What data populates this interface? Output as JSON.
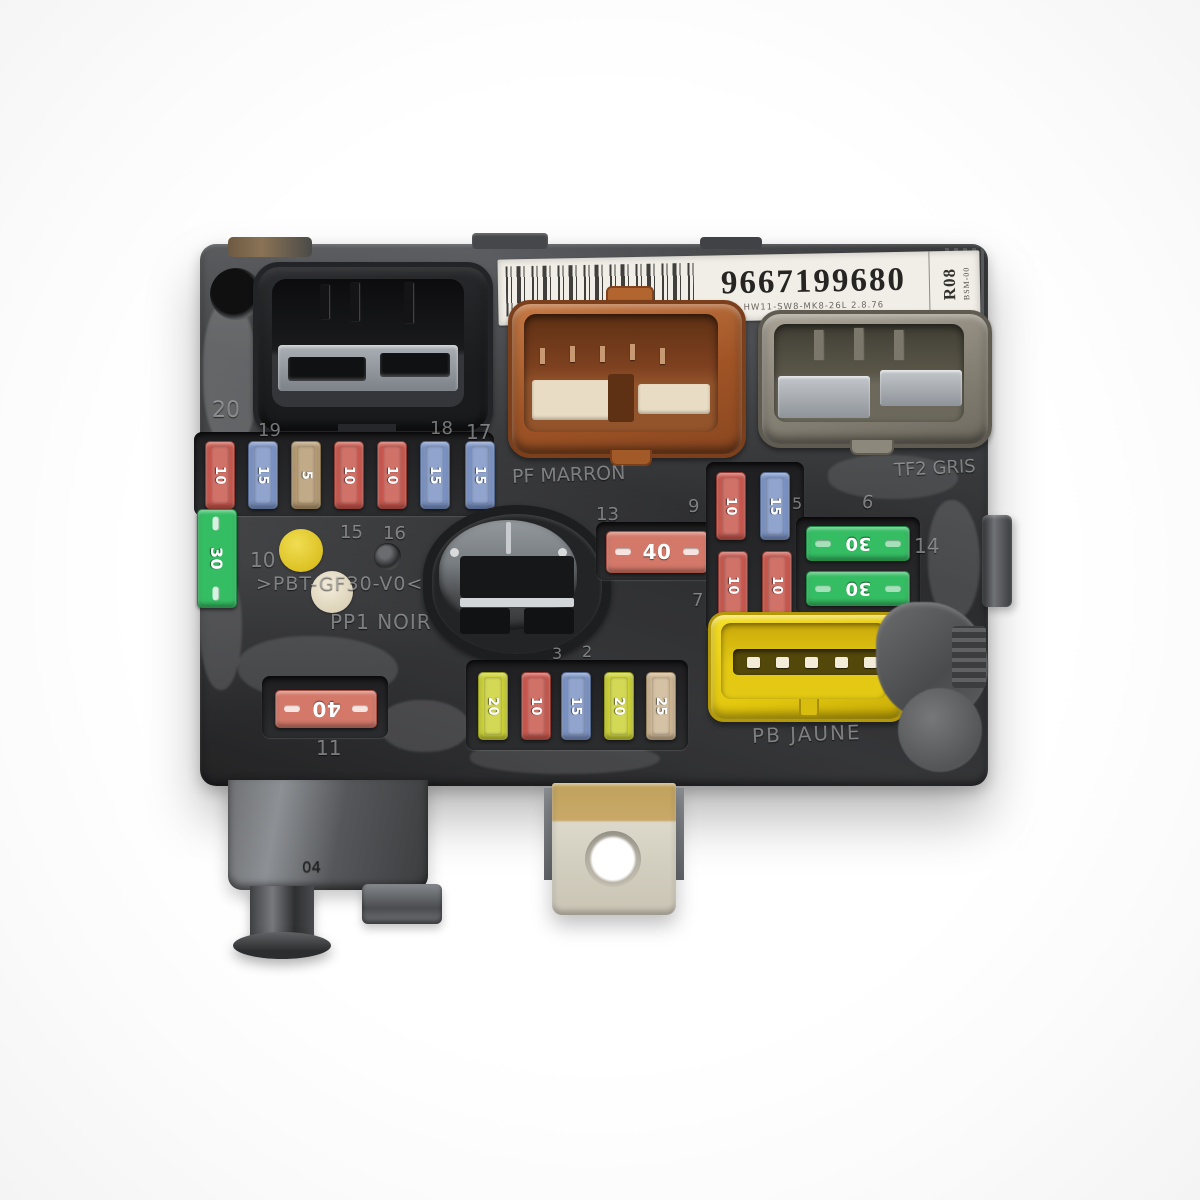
{
  "label": {
    "part_number": "9667199680",
    "revision_line": "HW11-SW8-MK8-26L  2.8.76",
    "side_code": "R08",
    "side_code_small": "BSM-00"
  },
  "connector_labels": {
    "orange": "PF MARRON",
    "gray": "TF2 GRIS",
    "yellow": "PB JAUNE"
  },
  "molded": {
    "material": ">PBT-GF30-V0<",
    "color_code": "PP1 NOIR",
    "foot_code": "04"
  },
  "slot_numbers": {
    "n20": "20",
    "n19": "19",
    "n18": "18",
    "n17": "17",
    "n16": "16",
    "n15": "15",
    "n14": "14",
    "n13": "13",
    "n11": "11",
    "n10": "10",
    "n9": "9",
    "n7": "7",
    "n6": "6",
    "n5": "5",
    "n3": "3",
    "n2": "2"
  },
  "fuses": {
    "top_row": [
      {
        "amp": "10",
        "color": "red"
      },
      {
        "amp": "15",
        "color": "blue"
      },
      {
        "amp": "5",
        "color": "tan"
      },
      {
        "amp": "10",
        "color": "red"
      },
      {
        "amp": "10",
        "color": "red"
      },
      {
        "amp": "15",
        "color": "blue"
      },
      {
        "amp": "15",
        "color": "blue"
      }
    ],
    "left_30": {
      "amp": "30",
      "color": "green"
    },
    "maxi_40": {
      "amp": "40",
      "color": "salmon"
    },
    "mid_cluster": [
      {
        "amp": "10",
        "color": "red"
      },
      {
        "amp": "15",
        "color": "blue"
      },
      {
        "amp": "10",
        "color": "red"
      },
      {
        "amp": "10",
        "color": "red"
      }
    ],
    "green_pair": [
      {
        "amp": "30",
        "color": "green"
      },
      {
        "amp": "30",
        "color": "green"
      }
    ],
    "bottom_row": [
      {
        "amp": "20",
        "color": "yellow"
      },
      {
        "amp": "10",
        "color": "red"
      },
      {
        "amp": "15",
        "color": "blue"
      },
      {
        "amp": "20",
        "color": "yellow"
      },
      {
        "amp": "25",
        "color": "tan"
      }
    ],
    "bottom_left_40": {
      "amp": "40",
      "color": "salmon"
    }
  }
}
